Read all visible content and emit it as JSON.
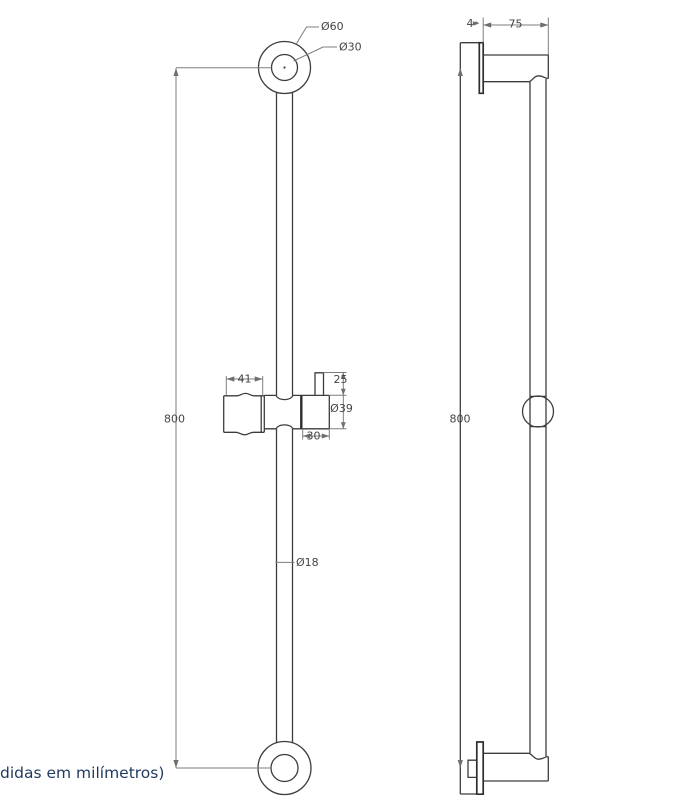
{
  "drawing_type": "shower slide bar technical drawing, front and side views",
  "colors": {
    "background": "#ffffff",
    "outline": "#3d3d3d",
    "dimension_lines": "#7e7e7e",
    "note_text": "#1f3a5f"
  },
  "front_view": {
    "dims": {
      "top_outer_diameter": "Ø60",
      "top_inner_diameter": "Ø30",
      "rail_length": "800",
      "holder_width": "41",
      "knob_height": "25",
      "slider_diameter": "Ø39",
      "slider_body_width": "30",
      "bar_diameter": "Ø18"
    }
  },
  "side_view": {
    "dims": {
      "plate_thickness": "4",
      "wall_projection": "75",
      "rail_length": "800"
    }
  },
  "note": {
    "text": "didas em milímetros)"
  }
}
